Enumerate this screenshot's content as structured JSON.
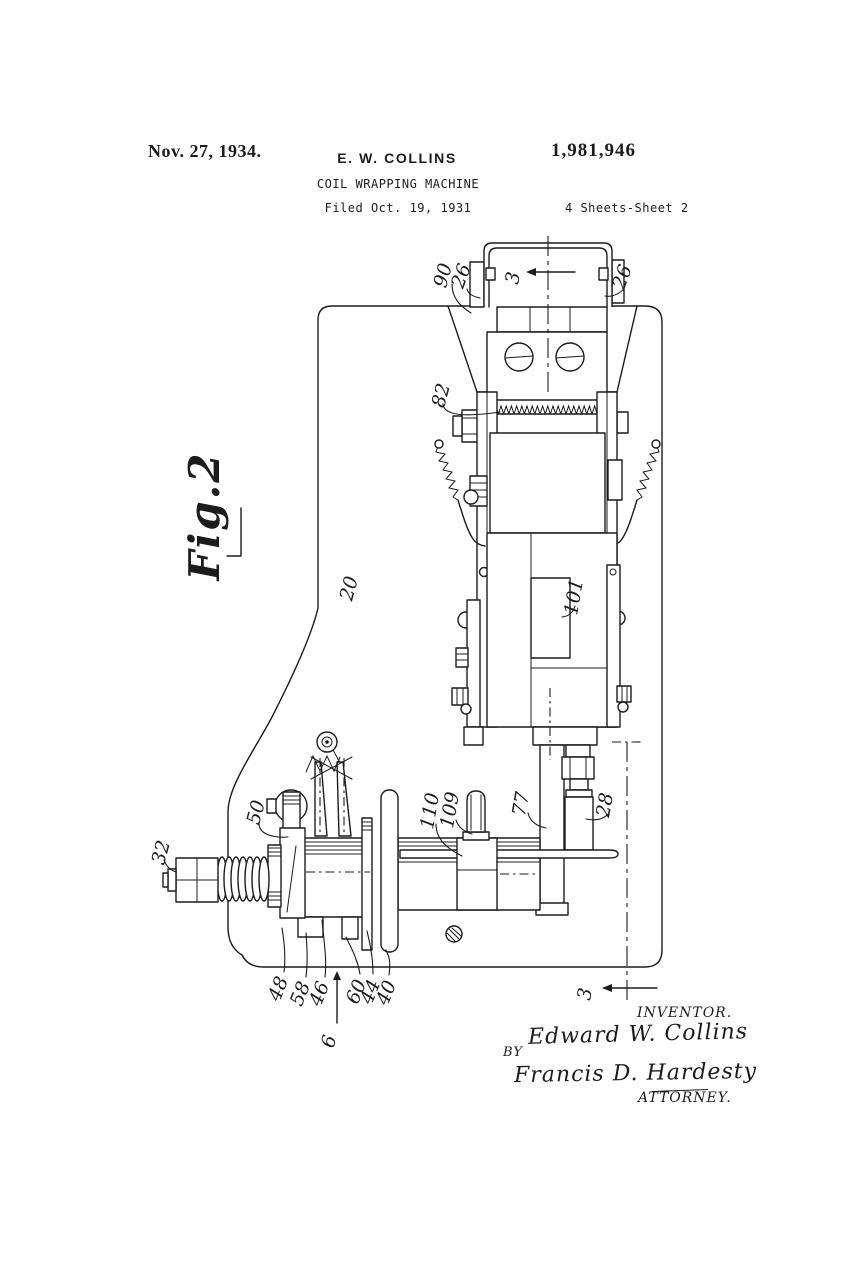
{
  "header": {
    "date": "Nov. 27, 1934.",
    "author": "E. W. COLLINS",
    "patent_number": "1,981,946",
    "title": "COIL WRAPPING MACHINE",
    "filed": "Filed Oct. 19, 1931",
    "sheet": "4 Sheets-Sheet 2"
  },
  "figure": {
    "name": "Fig.2",
    "labels": [
      {
        "part": "bracket-arm",
        "text": "90"
      },
      {
        "part": "clamp-left",
        "text": "26"
      },
      {
        "part": "section-top",
        "text": "3"
      },
      {
        "part": "clamp-right",
        "text": "26"
      },
      {
        "part": "serrated-blade",
        "text": "82"
      },
      {
        "part": "base-plate",
        "text": "20"
      },
      {
        "part": "slide-slot",
        "text": "101"
      },
      {
        "part": "carrier-block",
        "text": "110"
      },
      {
        "part": "stop-pin",
        "text": "109"
      },
      {
        "part": "hanger-bar",
        "text": "77"
      },
      {
        "part": "plunger",
        "text": "28"
      },
      {
        "part": "spool-body",
        "text": "50"
      },
      {
        "part": "knob",
        "text": "32"
      },
      {
        "part": "foot-a",
        "text": "48"
      },
      {
        "part": "foot-b",
        "text": "58"
      },
      {
        "part": "foot-c",
        "text": "46"
      },
      {
        "part": "foot-d",
        "text": "60"
      },
      {
        "part": "disk-bar",
        "text": "44"
      },
      {
        "part": "flange",
        "text": "40"
      },
      {
        "part": "view-arrow",
        "text": "6"
      },
      {
        "part": "section-bottom",
        "text": "3"
      }
    ]
  },
  "footer": {
    "inventor_caption": "INVENTOR.",
    "inventor_signature": "Edward W. Collins",
    "by_label": "BY",
    "attorney_signature": "Francis D. Hardesty",
    "attorney_caption": "ATTORNEY."
  }
}
